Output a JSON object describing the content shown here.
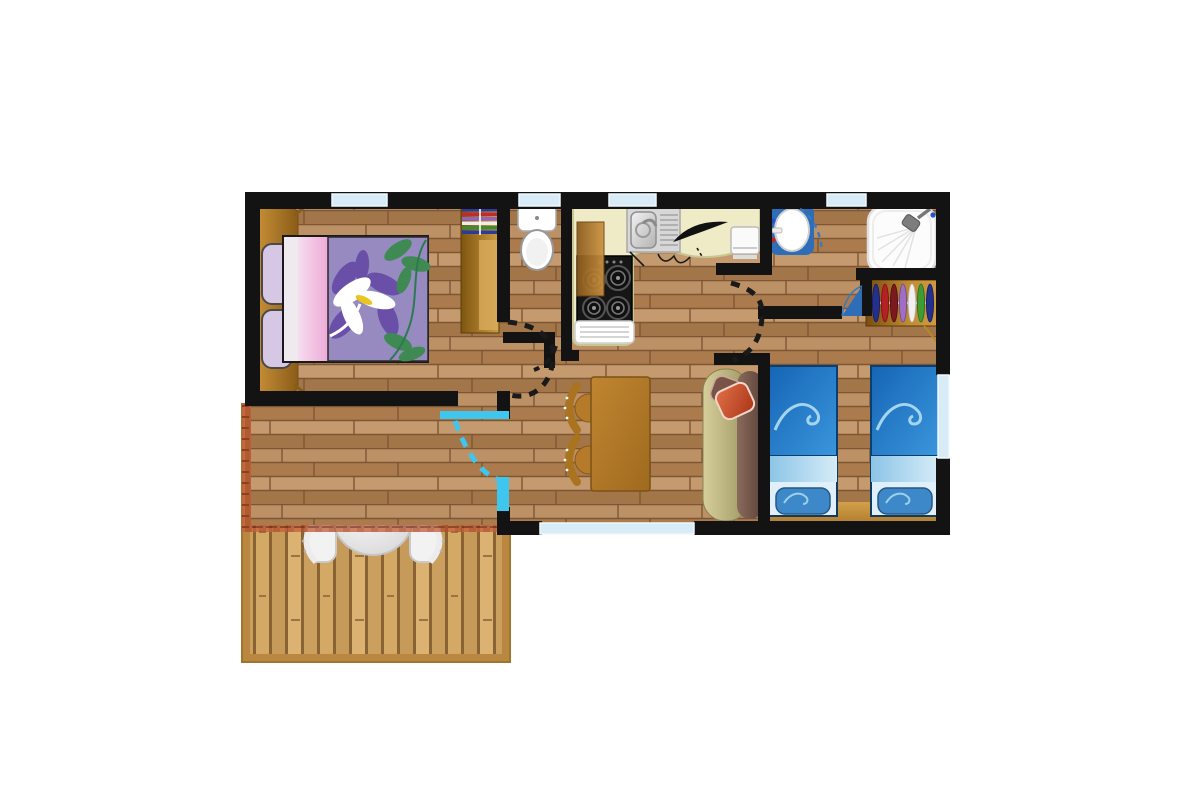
{
  "document": {
    "type": "floor-plan",
    "subject": "Top-view floor plan of a two-bedroom mobile home / chalet with covered wooden terrace",
    "background": "#ffffff"
  },
  "colors": {
    "wall": "#131313",
    "floor_base": "#b5885c",
    "window": "#d7ecf7",
    "entrance_door": "#3fc6ee",
    "interior_door": "#1a1a1a",
    "blue_door": "#2e6db8",
    "deck_frame": "#b9873f",
    "deck_plank": "#d4a966",
    "awning": "#c5613c",
    "awning_dark": "#b04f2c",
    "awning_line": "#7c2d18",
    "counter": "#eeebc6",
    "stove": "#161616",
    "sink_steel": "#d7d7d7",
    "appliance": "#fafafa",
    "toilet": "#ffffff",
    "shower": "#fcfcfc",
    "basin_frame": "#2e6db8",
    "bed_duvet": "#968ac0",
    "bed_pink": "#f0c4e2",
    "bed_white": "#efe9f0",
    "flower_purple": "#6a4fa8",
    "leaf_green": "#3e8a52",
    "cushion_lilac": "#d6c8e4",
    "bench_wood": "#b9822f",
    "wardrobe_wood": "#a06a1c",
    "twin_duvet": "#1f78c8",
    "twin_band": "#a8d0ec",
    "twin_sheet": "#dff0fa",
    "twin_pillow": "#2f80c4",
    "swirl_blue": "#a5d4ef",
    "tan_strip": "#c8943c",
    "sofa_seat": "#c2bb8a",
    "sofa_back": "#755349",
    "cushion_red": "#cc4f30",
    "table_wood": "#b8812c",
    "chair_wood": "#a9731f",
    "outdoor_white": "#f2f2f2"
  },
  "rooms": [
    {
      "name": "master-bedroom",
      "furniture": [
        "double-bed with purple flower duvet",
        "headboard bench with two lilac cushions",
        "shelf wardrobe with folded clothes"
      ]
    },
    {
      "name": "wc",
      "furniture": [
        "toilet"
      ]
    },
    {
      "name": "kitchen",
      "furniture": [
        "cream counter",
        "stainless sink with drainer",
        "4-burner hob",
        "fridge",
        "tall cabinet",
        "small white appliance",
        "dark bread/knife object"
      ]
    },
    {
      "name": "washbasin-nook",
      "furniture": [
        "blue-framed washbasin with hot/cold taps"
      ]
    },
    {
      "name": "shower-room",
      "furniture": [
        "shower tray with shower head"
      ]
    },
    {
      "name": "twin-bedroom",
      "furniture": [
        "single bed with blue wave duvet",
        "single bed with blue wave duvet",
        "open wardrobe with hanging clothes"
      ]
    },
    {
      "name": "living-dining",
      "furniture": [
        "rectangular dining table",
        "two wooden chairs",
        "sofa with red cushion"
      ]
    },
    {
      "name": "terrace",
      "furniture": [
        "round white table",
        "four white chairs",
        "corrugated awning over half the deck"
      ]
    }
  ],
  "openings": {
    "top_wall_windows": 4,
    "bottom_wall_windows": 1,
    "right_wall_windows": 1,
    "interior_doors_black_dashed": 3,
    "bathroom_door_blue_dashed": 1,
    "twin_bedroom_door_blue_leaf": 1,
    "entrance_door_cyan_dashed": 1
  }
}
